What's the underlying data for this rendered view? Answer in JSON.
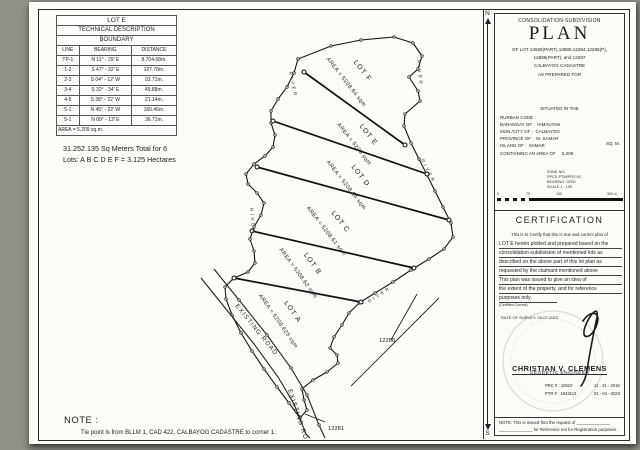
{
  "colors": {
    "ink": "#1f1f1f",
    "paper": "#fbfbf8",
    "background": "#8f8f88",
    "seal": "#c2b094"
  },
  "table": {
    "title": "LOT E",
    "subtitle": "TECHNICAL DESCRIPTION",
    "subtitle2": "BOUNDARY",
    "headers": [
      "LINE",
      "BEARING",
      "DISTANCE"
    ],
    "rows": [
      [
        "TP-1",
        "N 11° - 29' E",
        "8,704.68m."
      ],
      [
        "1-2",
        "S 47° - 32' E",
        "127.78m."
      ],
      [
        "2-3",
        "S 04° - 12' W",
        "03.71m."
      ],
      [
        "3-4",
        "S 32° - 34' E",
        "49.88m."
      ],
      [
        "4-5",
        "S 38° - 22' W",
        "21.14m."
      ],
      [
        "5-1",
        "N 45° - 22' W",
        "160.46m."
      ],
      [
        "5-1",
        "N 09° - 13' E",
        "36.71m."
      ]
    ],
    "area_note": "AREA = 5,209 sq.m."
  },
  "summary": {
    "line1": "31.252.135 Sq Meters Total for 6",
    "line2": "Lots: A B C D E F  =  3.125 Hectares"
  },
  "map": {
    "lots": [
      {
        "name": "LOT F",
        "area": "AREA = 5208.64 sqm"
      },
      {
        "name": "LOT E",
        "area": "AREA = 5209 sqm"
      },
      {
        "name": "LOT D",
        "area": "AREA = 5208.64 sqm"
      },
      {
        "name": "LOT C",
        "area": "AREA = 5208.61 sqm"
      },
      {
        "name": "LOT B",
        "area": "AREA = 5208.62 sqm"
      },
      {
        "name": "LOT A",
        "area": "AREA = 5208.625 sqm"
      }
    ],
    "river": "RIVER",
    "road": "EXISTING ROAD",
    "adjacent_lot_right": "12288",
    "adjacent_lot_bottom": "12281",
    "note_label": "NOTE :",
    "note_text": "Tie point is from BLLM 1, CAD 422, CALBAYOG CADASTRE to corner 1."
  },
  "compass": {
    "north": "N",
    "south": "S"
  },
  "title_block": {
    "header": "CONSOLIDATION-SUBDIVISION",
    "plan": "PLAN",
    "of_lot_line1": "OF  LOT  13686(PART),13885,12284,12285(P),",
    "of_lot_line2": "12886(PART),  and  12287",
    "cadastre": "CALBAYOG  CADASTRE",
    "prepared_for": "AS PREPARED FOR",
    "situated": "SITUATED IN THE",
    "fields": {
      "rurban_label": "RURBAN CODE :",
      "barangay_label": "BARANGAY OF :",
      "barangay_value": "HIMAUTAN",
      "mun_label": "MUN./CITY OF :",
      "mun_value": "CALBAYOG",
      "province_label": "PROVINCE OF :",
      "province_value": "W. SAMAR",
      "island_label": "ISLAND OF :",
      "island_value": "SAMAR",
      "sqm": "SQ. M.",
      "area_label": "CONTAINING AN AREA OF",
      "area_value": "5,209"
    },
    "zone": {
      "l1": "ZONE NO:",
      "l2": "PPCS-PTM/PRS 92",
      "l3": "BEARING: GRID",
      "l4": "SCALE 1 : 100"
    },
    "scale_labels": {
      "s0": "0",
      "s1": "75",
      "s2": "150",
      "s3": "300 m."
    },
    "certification": {
      "title": "CERTIFICATION",
      "intro": "This is to Certify that this is true and correct plan of",
      "lines": [
        "LOT E herein plotted and prepared based on the",
        "consolidation-subdivision of mentioned lots as",
        "described on the above part of this lot plan as",
        "requested by the claimant mentioned above",
        "      This plan was issued to give an idea of",
        "the extent of the property, and for reference",
        "purposes only."
      ],
      "certified": "(Certified Correct)"
    },
    "date_of_survey": "DATE OF SURVEY: 03-07-2023",
    "engineer": {
      "name": "CHRISTIAN V. CLEMENS",
      "title": "GEODETIC ENGINEER",
      "prc": "PRC # : 10510",
      "prc_date": "11 - 21 - 2018",
      "ptr": "PTR # : 1943113",
      "ptr_date": "01 - 04 - 2023"
    },
    "footer_line1": "NOTE:  This is issued thru the request of ______________",
    "footer_line2": "______________  for Reference not for Registration purposes."
  }
}
